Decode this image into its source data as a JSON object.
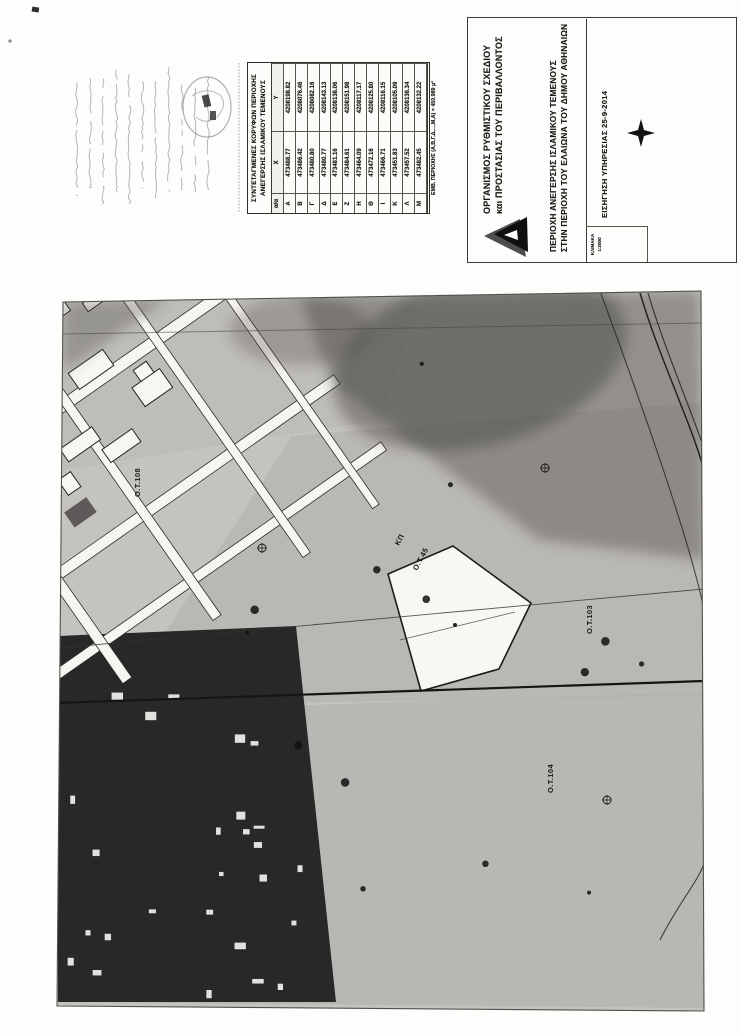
{
  "colors": {
    "paper": "#fdfdfc",
    "map_base": "#eceae7",
    "wash": "#b3b1ac",
    "smudge": "#4c4a47",
    "street": "#f6f5f2",
    "ink": "#1d1d1b"
  },
  "coord_table": {
    "title_line1": "ΣΥΝΤΕΤΑΓΜΕΝΕΣ ΚΟΡΥΦΩΝ ΠΕΡΙΟΧΗΣ",
    "title_line2": "ΑΝΕΓΕΡΣΗΣ ΙΣΛΑΜΙΚΟΥ ΤΕΜΕΝΟΥΣ",
    "columns": [
      "α/α",
      "X",
      "Y"
    ],
    "rows": [
      [
        "Α",
        "473488.77",
        "4208198.82"
      ],
      [
        "Β",
        "473486.42",
        "4208076.46"
      ],
      [
        "Γ",
        "473480.80",
        "4208082.16"
      ],
      [
        "Δ",
        "473480.77",
        "4208143.13"
      ],
      [
        "Ε",
        "473481.16",
        "4208138.06"
      ],
      [
        "Ζ",
        "473484.61",
        "4208151.98"
      ],
      [
        "Η",
        "473464.09",
        "4208117.17"
      ],
      [
        "Θ",
        "473472.16",
        "4208125.80"
      ],
      [
        "Ι",
        "473466.71",
        "4208116.15"
      ],
      [
        "Κ",
        "473451.83",
        "4208105.09"
      ],
      [
        "Λ",
        "473457.52",
        "4208136.34"
      ],
      [
        "Μ",
        "473482.45",
        "4208132.22"
      ]
    ],
    "footer": "ΕΜΒ. ΠΕΡΙΟΧΗΣ (Α,Β,Γ,Δ,...,Μ,Α) = 450.989 μ²"
  },
  "title_block": {
    "org_line1": "ΟΡΓΑΝΙΣΜΟΣ ΡΥΘΜΙΣΤΙΚΟΥ ΣΧΕΔΙΟΥ",
    "org_line2": "και ΠΡΟΣΤΑΣΙΑΣ ΤΟΥ ΠΕΡΙΒΑΛΛΟΝΤΟΣ",
    "project_line1": "ΠΕΡΙΟΧΗ ΑΝΕΓΕΡΣΗΣ ΙΣΛΑΜΙΚΟΥ ΤΕΜΕΝΟΥΣ",
    "project_line2": "ΣΤΗΝ ΠΕΡΙΟΧΗ ΤΟΥ ΕΛΑΙΩΝΑ ΤΟΥ ΔΗΜΟΥ ΑΘΗΝΑΙΩΝ",
    "note": "ΕΙΣΗΓΗΣΗ ΥΠΗΡΕΣΙΑΣ 25-9-2014",
    "scale_label": "ΚΛΙΜΑΚΑ",
    "scale_value": "1:2000"
  },
  "map": {
    "labels": [
      {
        "text": "Ο.Τ.108",
        "x": 140,
        "y": 497,
        "r": -90
      },
      {
        "text": "ΚΠ",
        "x": 399,
        "y": 546,
        "r": -62
      },
      {
        "text": "Ο.Τ.45",
        "x": 417,
        "y": 571,
        "r": -62
      },
      {
        "text": "Ο.Τ.103",
        "x": 592,
        "y": 634,
        "r": -90
      },
      {
        "text": "Ο.Τ.104",
        "x": 553,
        "y": 793,
        "r": -90
      }
    ]
  }
}
